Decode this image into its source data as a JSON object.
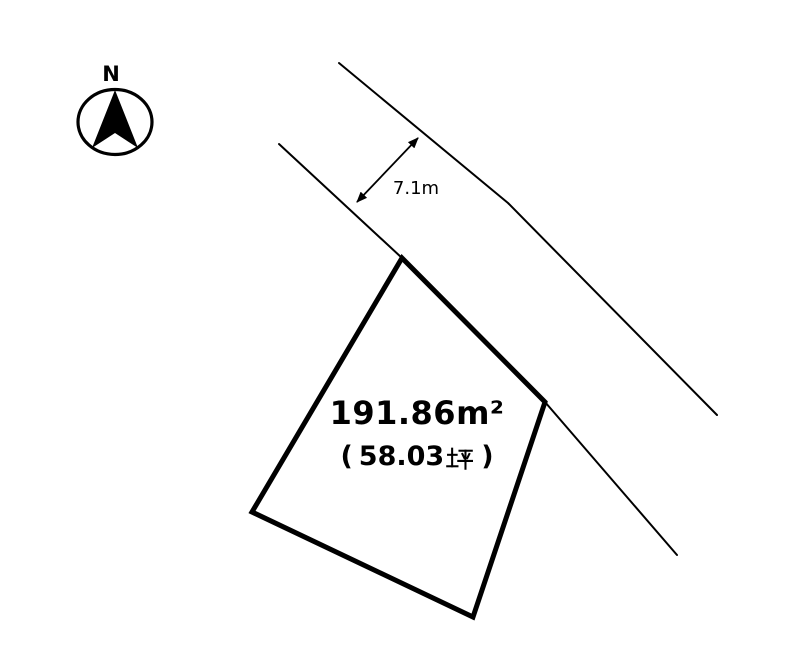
{
  "compass": {
    "north_label": "N"
  },
  "road": {
    "width_label": "7.1m"
  },
  "parcel": {
    "area_sqm_label": "191.86m²",
    "area_tsubo_open": "(",
    "area_tsubo_value": "58.03",
    "area_tsubo_unit": "坪",
    "area_tsubo_close": ")"
  },
  "geometry": {
    "road_upper_edge": [
      [
        339,
        63
      ],
      [
        508,
        203
      ],
      [
        717,
        415
      ]
    ],
    "road_lower_edge": [
      [
        279,
        144
      ],
      [
        402,
        258
      ],
      [
        545,
        402
      ],
      [
        677,
        555
      ]
    ],
    "parcel_outline": [
      [
        402,
        258
      ],
      [
        545,
        402
      ],
      [
        473,
        617
      ],
      [
        252,
        512
      ]
    ],
    "dimension_arrow": {
      "from": [
        357,
        202
      ],
      "to": [
        418,
        138
      ]
    }
  },
  "colors": {
    "line": "#000000",
    "background": "#ffffff"
  }
}
